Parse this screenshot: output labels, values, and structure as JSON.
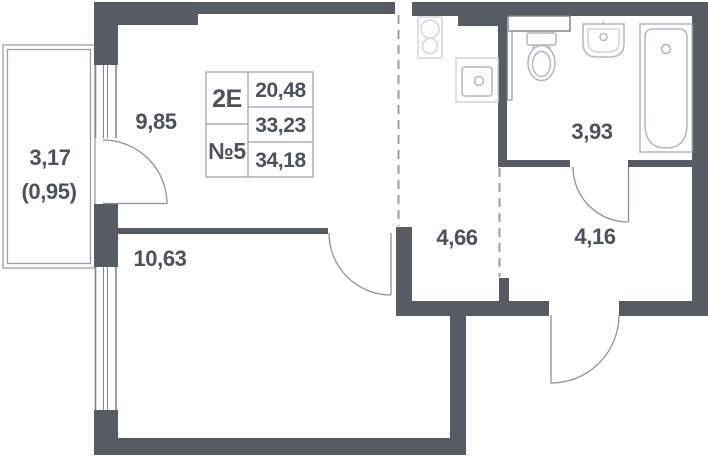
{
  "unit_card": {
    "type": "2Е",
    "number": "№5",
    "living_area": "20,48",
    "area_main": "33,23",
    "area_total": "34,18"
  },
  "rooms": {
    "living_kitchen": {
      "area": "9,85"
    },
    "balcony": {
      "area": "3,17",
      "area_reduced": "(0,95)"
    },
    "bedroom": {
      "area": "10,63"
    },
    "corridor": {
      "area": "4,66"
    },
    "bathroom": {
      "area": "3,93"
    },
    "hallway": {
      "area": "4,16"
    }
  },
  "colors": {
    "wall": "#565b64",
    "text": "#4b525b",
    "line": "#9aa0a8",
    "door": "#8d939c",
    "fixture": "#b3b8bf",
    "window": "#80868f",
    "tableb": "#9aa0a7",
    "bg": "#ffffff"
  }
}
